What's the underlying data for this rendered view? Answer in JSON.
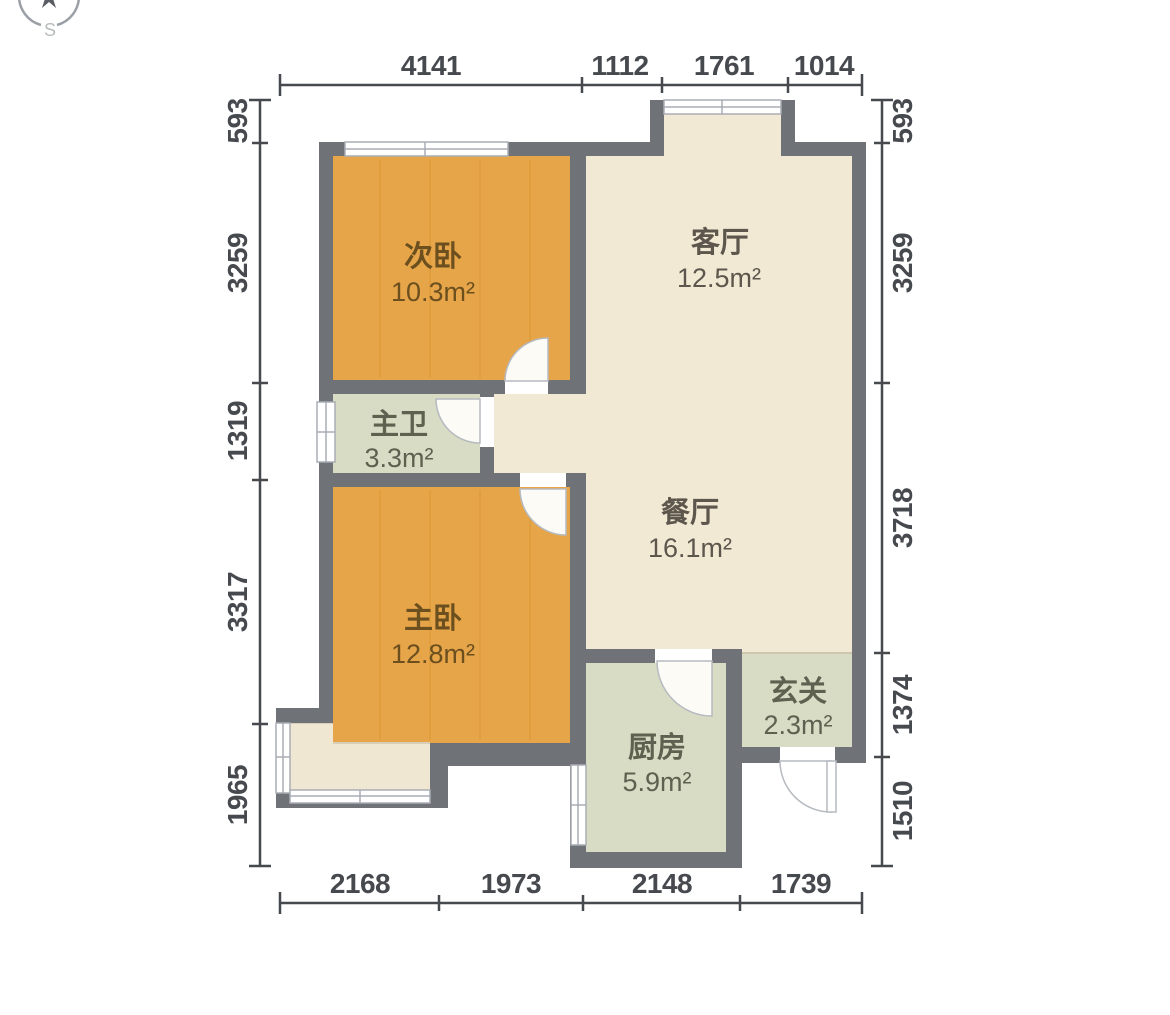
{
  "compass": {
    "south_label": "S"
  },
  "rooms": {
    "secondary_bedroom": {
      "name": "次卧",
      "area": "10.3m²"
    },
    "living_room": {
      "name": "客厅",
      "area": "12.5m²"
    },
    "master_bath": {
      "name": "主卫",
      "area": "3.3m²"
    },
    "dining_room": {
      "name": "餐厅",
      "area": "16.1m²"
    },
    "master_bedroom": {
      "name": "主卧",
      "area": "12.8m²"
    },
    "kitchen": {
      "name": "厨房",
      "area": "5.9m²"
    },
    "entry": {
      "name": "玄关",
      "area": "2.3m²"
    }
  },
  "dimensions": {
    "top": [
      "4141",
      "1112",
      "1761",
      "1014"
    ],
    "bottom": [
      "2168",
      "1973",
      "2148",
      "1739"
    ],
    "left": [
      "593",
      "3259",
      "1319",
      "3317",
      "1965"
    ],
    "right": [
      "593",
      "3259",
      "3718",
      "1374",
      "1510"
    ]
  },
  "colors": {
    "wall": "#6f7378",
    "bedroom_floor": "#e7a549",
    "living_floor": "#f2e9d5",
    "service_floor": "#d8dcc4",
    "balcony_floor": "#f0e7d2",
    "dim": "#46494e",
    "bedroom_text": "#6b4f1f",
    "living_text": "#5c564c",
    "service_text": "#5f6150"
  }
}
